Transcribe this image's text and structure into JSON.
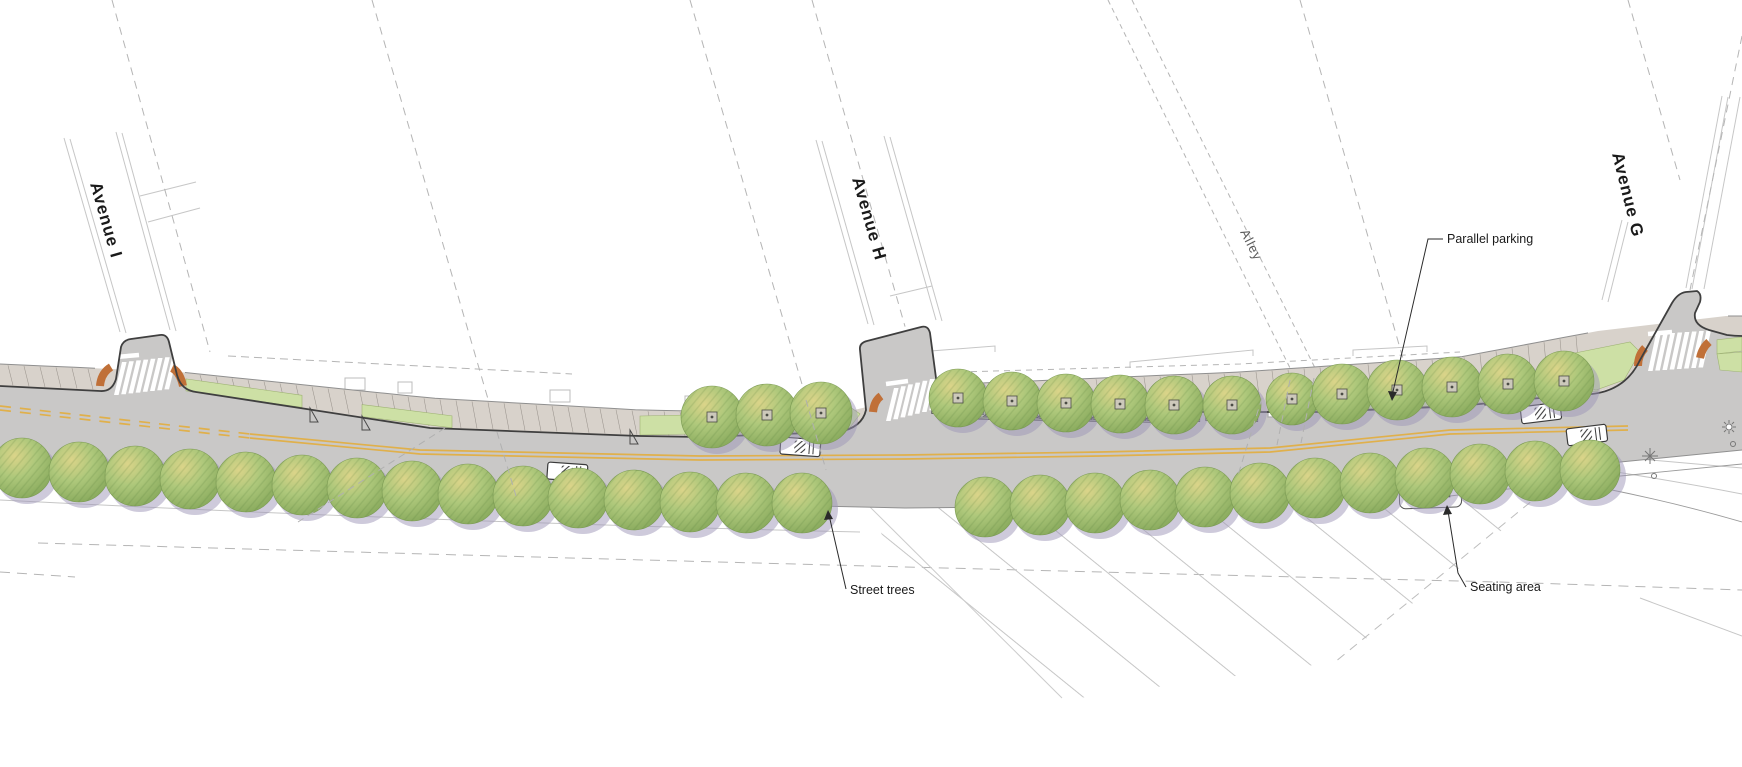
{
  "streets": {
    "avenue_i": "Avenue I",
    "avenue_h": "Avenue H",
    "avenue_g": "Avenue G",
    "alley": "Alley"
  },
  "annotations": {
    "parallel_parking": "Parallel parking",
    "street_trees": "Street trees",
    "seating_area": "Seating area"
  },
  "colors": {
    "road": "#c9c8c7",
    "sidewalk": "#d8d2cb",
    "planting": "#cde0a5",
    "planting_edge": "#9fb374",
    "tree_hi": "#dbd489",
    "tree_mid": "#aec87b",
    "tree_lo": "#85a75a",
    "tree_shadow": "#9d96b8",
    "curb_ramp": "#c07038",
    "centerline_yellow": "#e0b04b",
    "curb": "#3f3f3f",
    "line_light": "#c6c6c6",
    "hatch": "#c3c3c3",
    "marking_white": "#ffffff",
    "leader": "#2a2a2a"
  }
}
